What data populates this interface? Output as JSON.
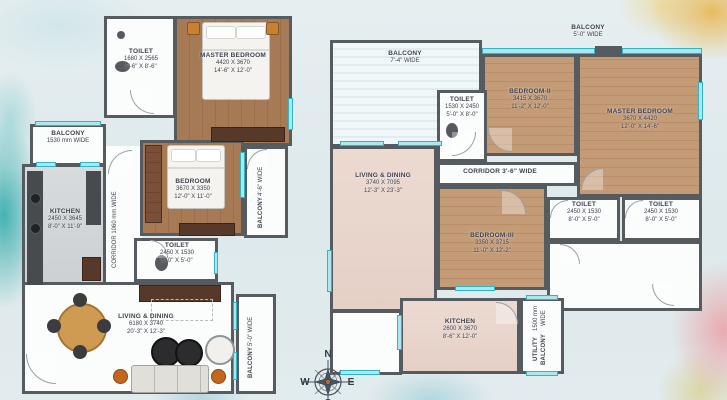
{
  "palette": {
    "wall": "#565b60",
    "window_fill": "#a8e9f0",
    "window_border": "#35b3c6",
    "wood_dark": "#a77a56",
    "wood_light": "#c49b77",
    "tile_pink": "#ead8cf",
    "kitchen_grey": "#d6d9da",
    "background": "#e3ecee"
  },
  "left_plan": {
    "toilet_top": {
      "name": "TOILET",
      "mm": "1680 X 2565",
      "ft": "5'-6\" X 8'-6\""
    },
    "master_bedroom": {
      "name": "MASTER BEDROOM",
      "mm": "4420 X 3670",
      "ft": "14'-6\" X 12'-0\""
    },
    "balcony_left": {
      "name": "BALCONY",
      "mm": "1530 mm WIDE"
    },
    "kitchen": {
      "name": "KITCHEN",
      "mm": "2450 X 3645",
      "ft": "8'-0\" X 11'-9\""
    },
    "corridor": {
      "name": "CORRIDOR 1060 mm WIDE"
    },
    "bedroom": {
      "name": "BEDROOM",
      "mm": "3670 X 3350",
      "ft": "12'-0\" X 11'-0\""
    },
    "balcony_right": {
      "name": "BALCONY",
      "ft": "4'-6\" WIDE"
    },
    "toilet_mid": {
      "name": "TOILET",
      "mm": "2450 X 1530",
      "ft": "8'-0\" X 5'-0\""
    },
    "living_dining": {
      "name": "LIVING & DINING",
      "mm": "6180 X 3740",
      "ft": "20'-3\" X 12'-3\""
    },
    "balcony_bottom": {
      "name": "BALCONY",
      "ft": "5'-0\" WIDE"
    }
  },
  "right_plan": {
    "balcony_top_left": {
      "name": "BALCONY",
      "ft": "7'-4\" WIDE"
    },
    "balcony_top_right": {
      "name": "BALCONY",
      "ft": "5'-0\" WIDE"
    },
    "toilet_top": {
      "name": "TOILET",
      "mm": "1530 X 2450",
      "ft": "5'-0\" X 8'-0\""
    },
    "bedroom_2": {
      "name": "BEDROOM-II",
      "mm": "3415 X 3670",
      "ft": "11'-2\" X 12'-0\""
    },
    "master_bedroom": {
      "name": "MASTER BEDROOM",
      "mm": "3670 X 4420",
      "ft": "12'-0\" X 14'-6\""
    },
    "living_dining": {
      "name": "LIVING & DINING",
      "mm": "3740 X 7095",
      "ft": "12'-3\" X 23'-3\""
    },
    "corridor": {
      "name": "CORRIDOR 3'-6\" WIDE"
    },
    "bedroom_3": {
      "name": "BEDROOM-III",
      "mm": "3350 X 3715",
      "ft": "11'-0\" X 12'-2\""
    },
    "toilet_a": {
      "name": "TOILET",
      "mm": "2450 X 1530",
      "ft": "8'-0\" X 5'-0\""
    },
    "toilet_b": {
      "name": "TOILET",
      "mm": "2450 X 1530",
      "ft": "8'-0\" X 5'-0\""
    },
    "kitchen": {
      "name": "KITCHEN",
      "mm": "2600 X 3670",
      "ft": "8'-6\" X 12'-0\""
    },
    "utility_balcony": {
      "name": "UTILITY BALCONY",
      "mm": "1500 mm WIDE"
    }
  },
  "compass": {
    "north": "N",
    "south": "S",
    "east": "E",
    "west": "W"
  }
}
